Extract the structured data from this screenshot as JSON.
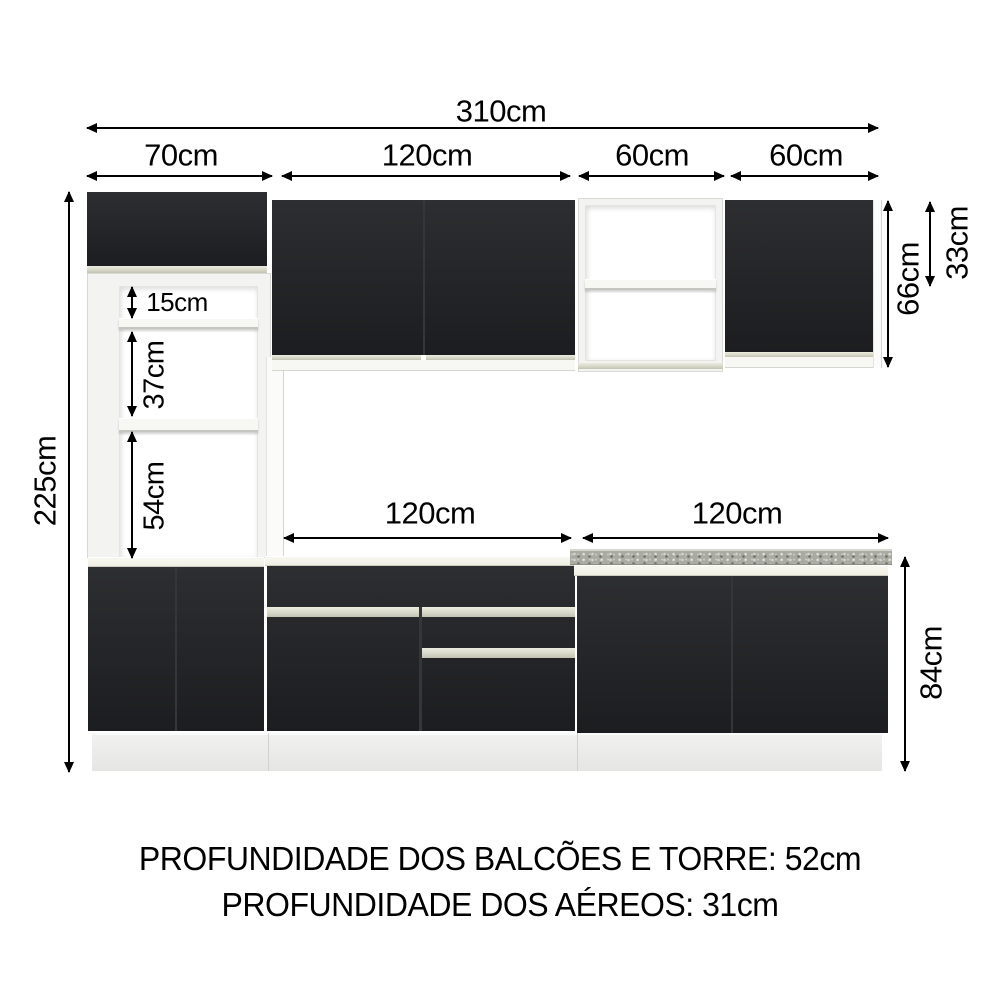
{
  "dims": {
    "total_width": {
      "label": "310cm"
    },
    "segments": [
      {
        "label": "70cm"
      },
      {
        "label": "120cm"
      },
      {
        "label": "60cm"
      },
      {
        "label": "60cm"
      }
    ],
    "tower_height": {
      "label": "225cm"
    },
    "tower_sections": [
      {
        "label": "15cm"
      },
      {
        "label": "37cm"
      },
      {
        "label": "54cm"
      }
    ],
    "upper_height": {
      "label": "66cm"
    },
    "upper_top_section": {
      "label": "33cm"
    },
    "counters": [
      {
        "label": "120cm"
      },
      {
        "label": "120cm"
      }
    ],
    "base_height": {
      "label": "84cm"
    }
  },
  "notes": {
    "depth_base": "PROFUNDIDADE DOS BALCÕES E TORRE: 52cm",
    "depth_upper": "PROFUNDIDADE DOS AÉREOS: 31cm"
  },
  "colors": {
    "door": "#202124",
    "handle": "#d8d8c9",
    "carcass": "#f3f3f1",
    "granite": "#a9aaa1",
    "counter_white": "#efefe4",
    "plinth": "#e5e5e4",
    "line": "#000000"
  }
}
